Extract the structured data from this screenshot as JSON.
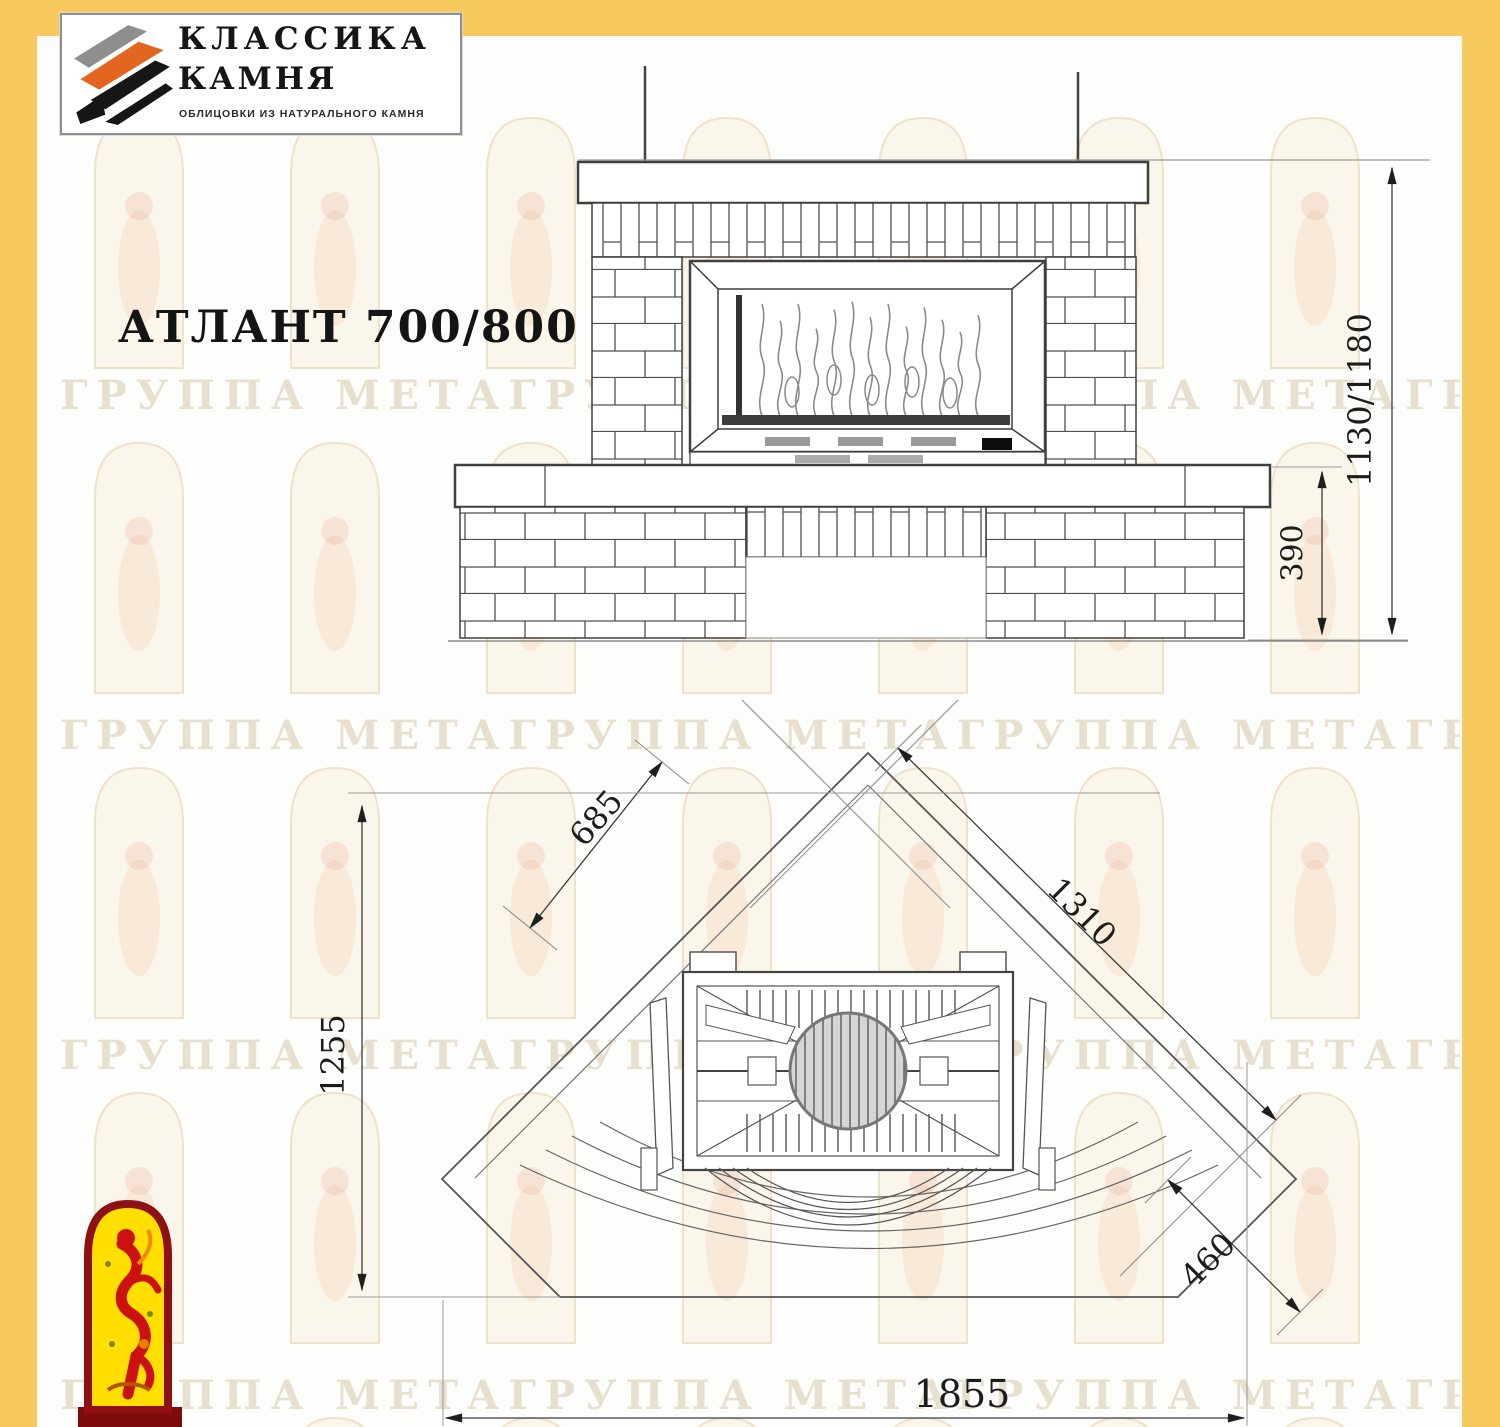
{
  "frame": {
    "color": "#F7C95E"
  },
  "logo": {
    "line1": "КЛАССИКА",
    "line2": "КАМНЯ",
    "tagline": "ОБЛИЦОВКИ ИЗ НАТУРАЛЬНОГО КАМНЯ"
  },
  "title": "АТЛАНТ 700/800",
  "watermark": {
    "text": "ГРУППА МЕТАГРУППА МЕТАГРУППА МЕТАГРУППА МЕ"
  },
  "views": {
    "front": "front-elevation",
    "plan": "plan-view"
  },
  "dimensions": {
    "overall_height": "1130/1180",
    "base_height": "390",
    "side_wall": "685",
    "front_diagonal": "1310",
    "depth": "1255",
    "corner_offset": "460",
    "overall_width": "1855"
  }
}
